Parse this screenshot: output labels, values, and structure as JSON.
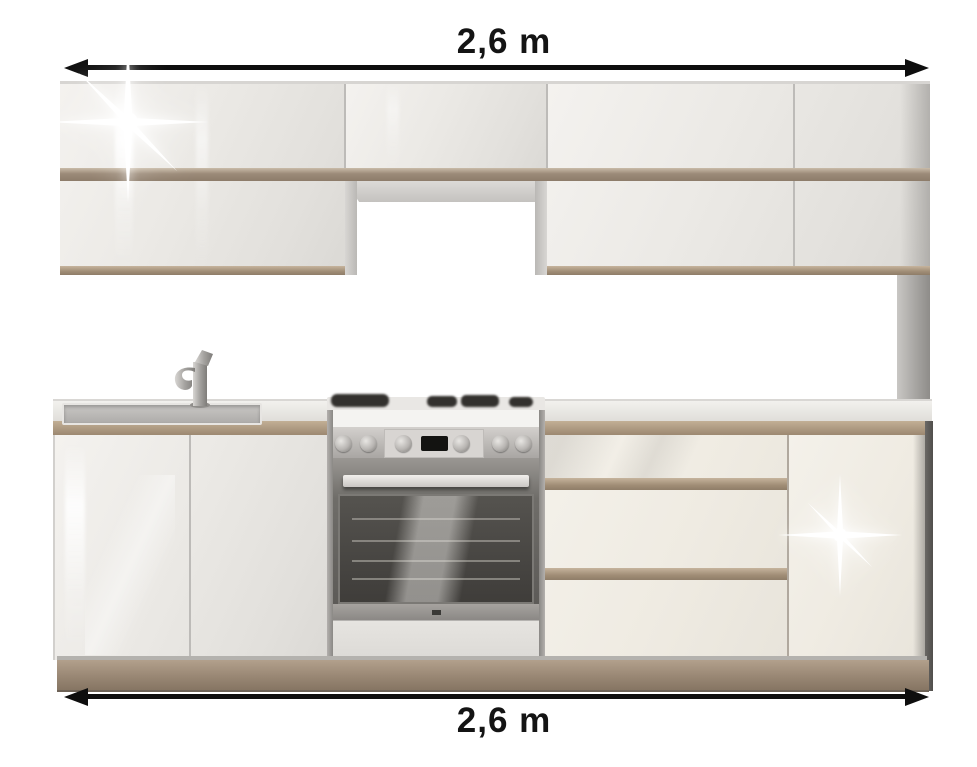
{
  "annotations": {
    "top": {
      "label": "2,6 m"
    },
    "bottom": {
      "label": "2,6 m"
    }
  },
  "colors": {
    "background": "#ffffff",
    "arrow": "#0e0e0e",
    "label_text": "#141414",
    "gloss_white_front": "#efede9",
    "cream_front": "#efebe2",
    "oak_accent_strip": "#9b8a78",
    "plinth_oak": "#9a8875",
    "worktop_edge": "#b3a086",
    "stainless_steel": "#c6c3c0",
    "oven_glass": "#46443f"
  },
  "scene": {
    "subject": "kitchen-unit-set",
    "elements": [
      "wall-cabinets",
      "extractor-hood-niche",
      "oak-accent-strips",
      "sink",
      "faucet",
      "worktop",
      "freestanding-cooker",
      "gas-hob",
      "oven",
      "drawer-unit",
      "base-door-cabinets",
      "side-panel",
      "plinth",
      "gloss-sparkle-highlights"
    ]
  }
}
